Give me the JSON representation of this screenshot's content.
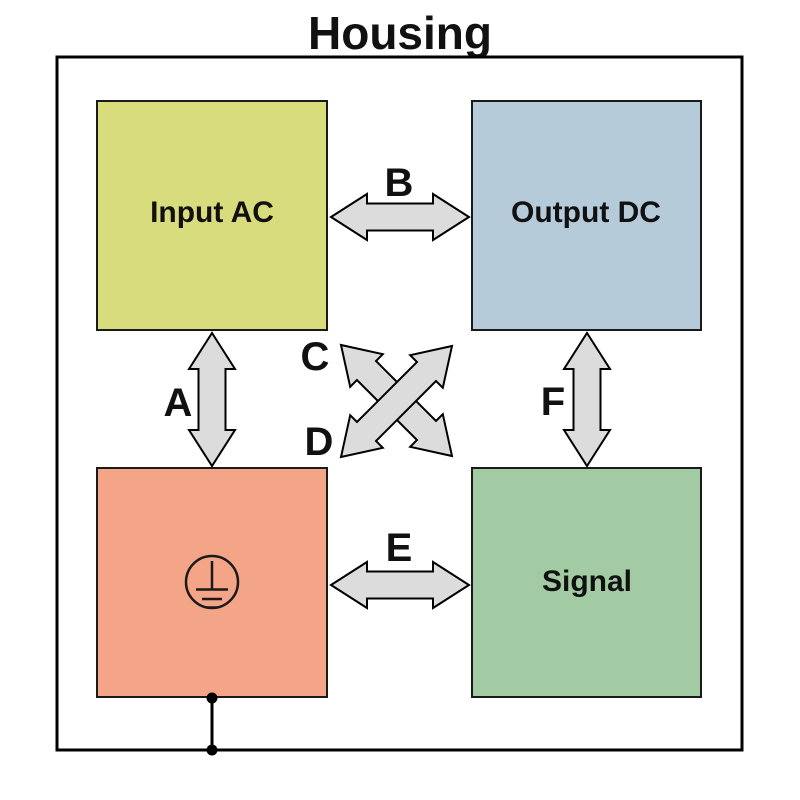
{
  "title": "Housing",
  "blocks": {
    "input_ac": {
      "label": "Input AC",
      "color": "#d8dc7c"
    },
    "output_dc": {
      "label": "Output DC",
      "color": "#b5cbd9"
    },
    "protective_earth": {
      "color": "#f4a588",
      "icon": "protective-earth-ground-icon"
    },
    "signal": {
      "label": "Signal",
      "color": "#a3cba3"
    }
  },
  "connections": {
    "a": {
      "label": "A"
    },
    "b": {
      "label": "B"
    },
    "c": {
      "label": "C"
    },
    "d": {
      "label": "D"
    },
    "e": {
      "label": "E"
    },
    "f": {
      "label": "F"
    }
  },
  "arrow_color": "#dcdcdc",
  "outline_color": "#1a1a1a"
}
